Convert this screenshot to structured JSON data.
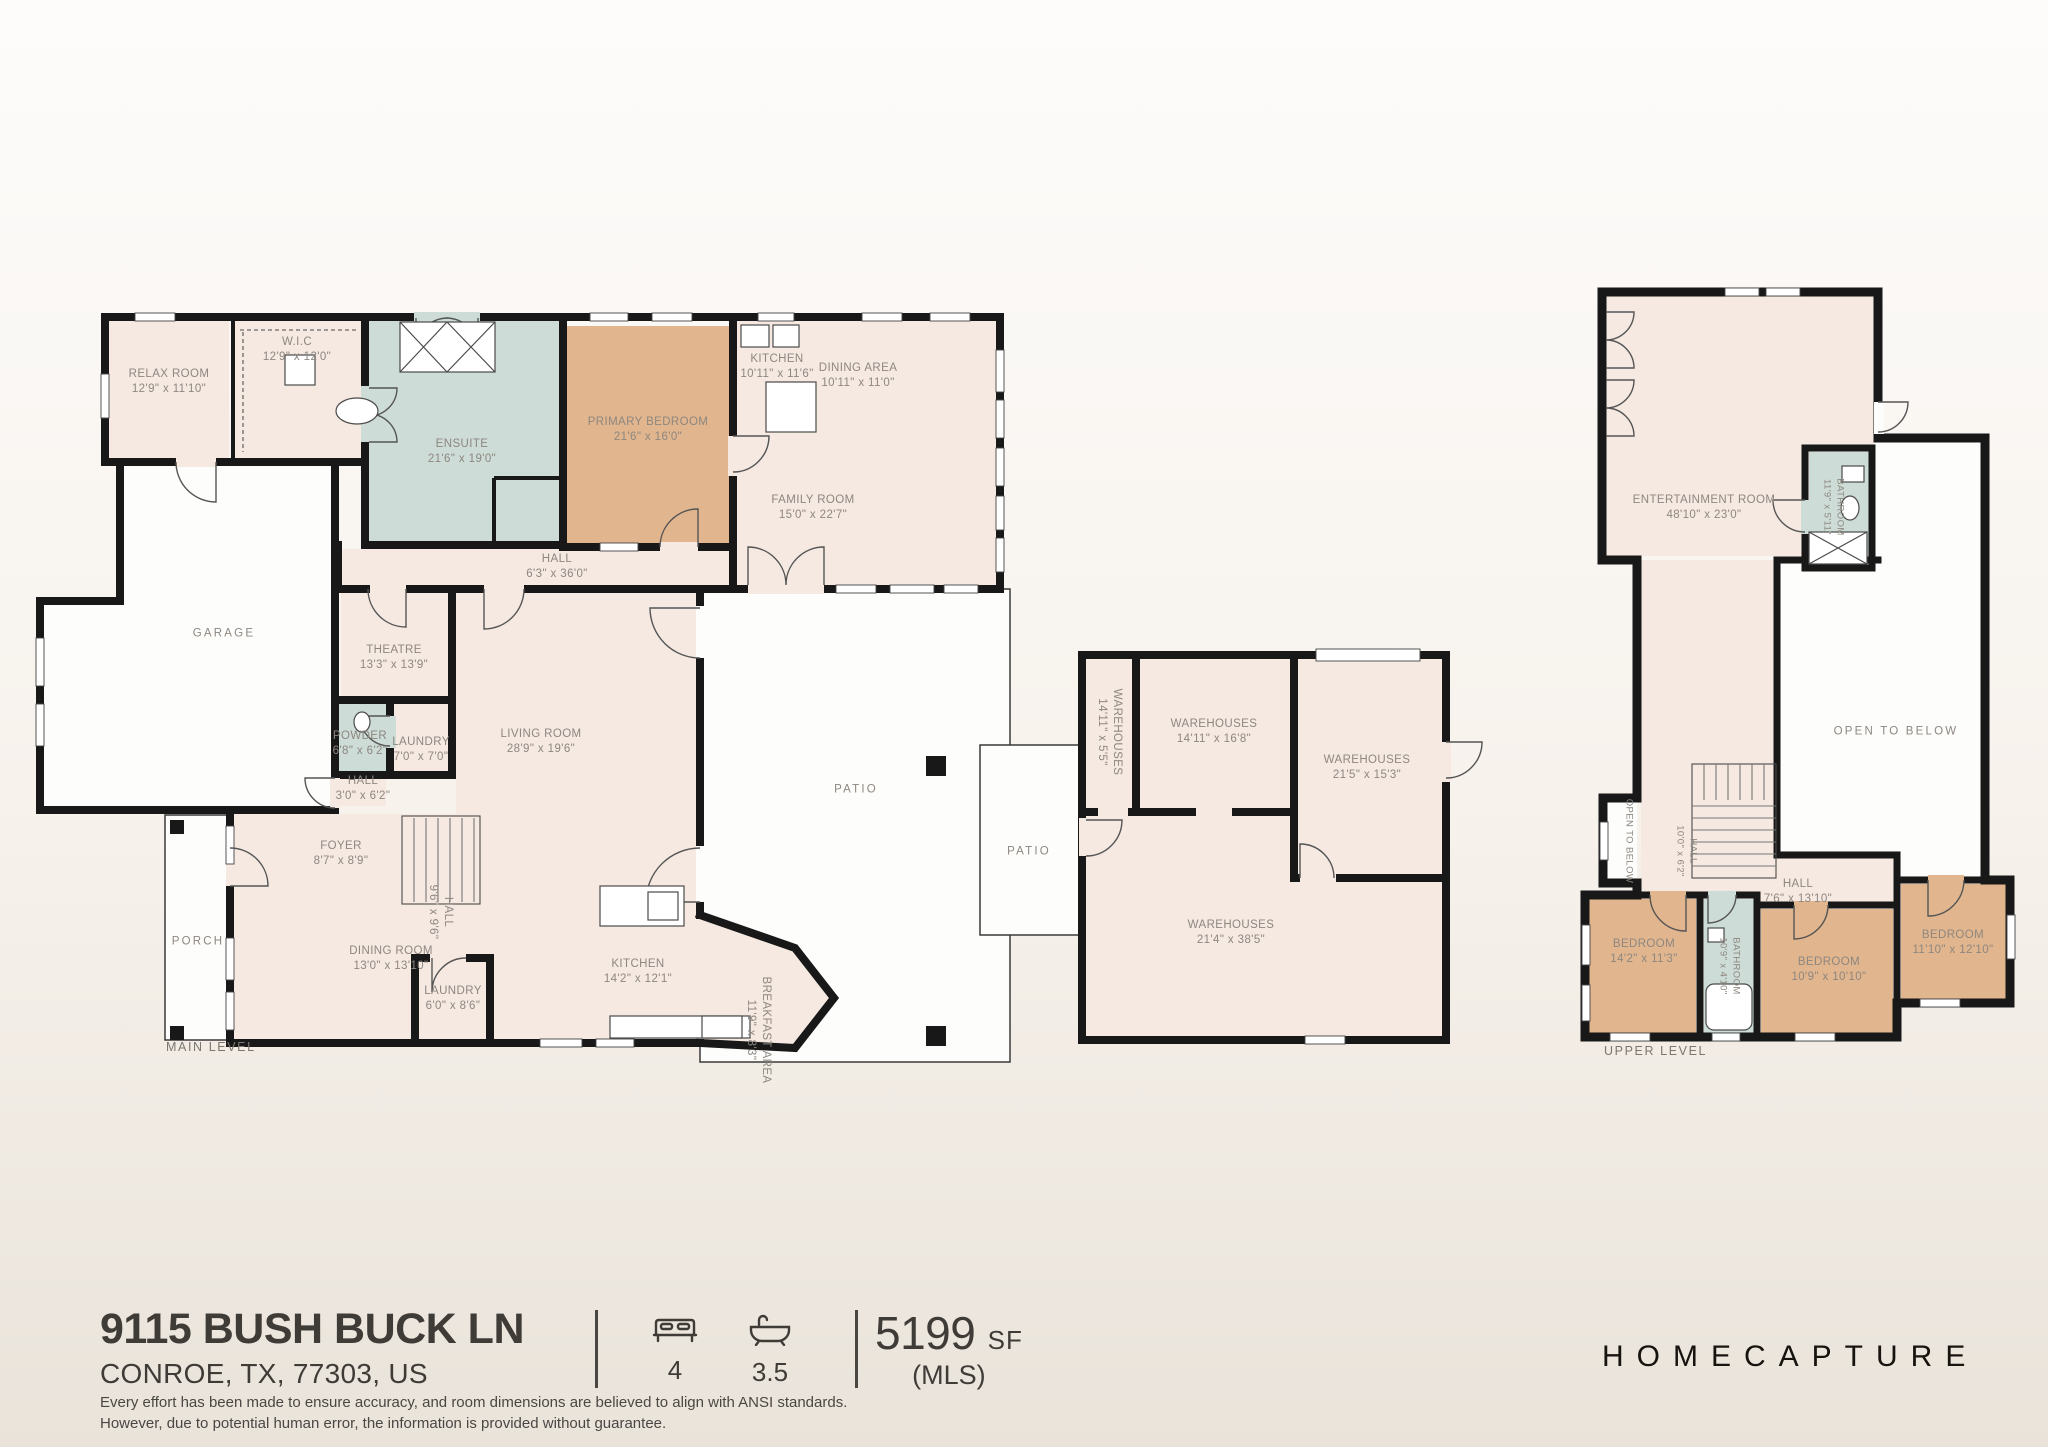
{
  "palette": {
    "room_fill": "#f5e9e2",
    "bath_fill": "#cddcd7",
    "bedroom_fill": "#e1b58d",
    "wall": "#181818",
    "label_text": "#8e8780",
    "footer_text": "#3f3b37"
  },
  "plans": {
    "main": {
      "level_label": "MAIN LEVEL",
      "rooms": [
        {
          "name": "RELAX ROOM",
          "dims": "12'9\" x 11'10\""
        },
        {
          "name": "W.I.C",
          "dims": "12'9\" x 12'0\""
        },
        {
          "name": "ENSUITE",
          "dims": "21'6\" x 19'0\""
        },
        {
          "name": "PRIMARY BEDROOM",
          "dims": "21'6\" x 16'0\""
        },
        {
          "name": "KITCHEN",
          "dims": "10'11\" x 11'6\""
        },
        {
          "name": "DINING AREA",
          "dims": "10'11\" x 11'0\""
        },
        {
          "name": "FAMILY ROOM",
          "dims": "15'0\" x 22'7\""
        },
        {
          "name": "HALL",
          "dims": "6'3\" x 36'0\""
        },
        {
          "name": "GARAGE",
          "dims": ""
        },
        {
          "name": "THEATRE",
          "dims": "13'3\" x 13'9\""
        },
        {
          "name": "POWDER",
          "dims": "6'8\" x 6'2\""
        },
        {
          "name": "LAUNDRY",
          "dims": "7'0\" x 7'0\""
        },
        {
          "name": "HALL",
          "dims": "3'0\" x 6'2\""
        },
        {
          "name": "FOYER",
          "dims": "8'7\" x 8'9\""
        },
        {
          "name": "LIVING ROOM",
          "dims": "28'9\" x 19'6\""
        },
        {
          "name": "PATIO",
          "dims": ""
        },
        {
          "name": "PORCH",
          "dims": ""
        },
        {
          "name": "DINING ROOM",
          "dims": "13'0\" x 13'10\""
        },
        {
          "name": "LAUNDRY",
          "dims": "6'0\" x 8'6\""
        },
        {
          "name": "HALL",
          "dims": "9'6\" x 9'6\""
        },
        {
          "name": "KITCHEN",
          "dims": "14'2\" x 12'1\""
        },
        {
          "name": "BREAKFAST AREA",
          "dims": "11'9\" x 8'3\""
        }
      ]
    },
    "warehouse": {
      "rooms": [
        {
          "name": "WAREHOUSES",
          "dims": "14'11\" x 5'5\""
        },
        {
          "name": "WAREHOUSES",
          "dims": "14'11\" x 16'8\""
        },
        {
          "name": "WAREHOUSES",
          "dims": "21'5\" x 15'3\""
        },
        {
          "name": "WAREHOUSES",
          "dims": "21'4\" x 38'5\""
        },
        {
          "name": "PATIO",
          "dims": ""
        }
      ]
    },
    "upper": {
      "level_label": "UPPER LEVEL",
      "rooms": [
        {
          "name": "ENTERTAINMENT ROOM",
          "dims": "48'10\" x 23'0\""
        },
        {
          "name": "BATHROOM",
          "dims": "11'9\" x 5'11\""
        },
        {
          "name": "OPEN TO BELOW",
          "dims": ""
        },
        {
          "name": "OPEN TO BELOW",
          "dims": ""
        },
        {
          "name": "HALL",
          "dims": "10'0\" x 6'2\""
        },
        {
          "name": "HALL",
          "dims": "7'6\" x 13'10\""
        },
        {
          "name": "BEDROOM",
          "dims": "14'2\" x 11'3\""
        },
        {
          "name": "BATHROOM",
          "dims": "10'9\" x 4'10\""
        },
        {
          "name": "BEDROOM",
          "dims": "10'9\" x 10'10\""
        },
        {
          "name": "BEDROOM",
          "dims": "11'10\" x 12'10\""
        }
      ]
    }
  },
  "footer": {
    "address_line1": "9115 BUSH BUCK LN",
    "address_line2": "CONROE, TX, 77303, US",
    "beds_icon": "bed-icon",
    "beds": "4",
    "baths_icon": "bathtub-icon",
    "baths": "3.5",
    "area_value": "5199",
    "area_unit": "SF",
    "area_source": "(MLS)",
    "brand": "HOMECAPTURE",
    "disclaimer_line1": "Every effort has been made to ensure accuracy, and room dimensions are believed to align with ANSI standards.",
    "disclaimer_line2": "However, due to potential human error, the information is provided without guarantee."
  }
}
